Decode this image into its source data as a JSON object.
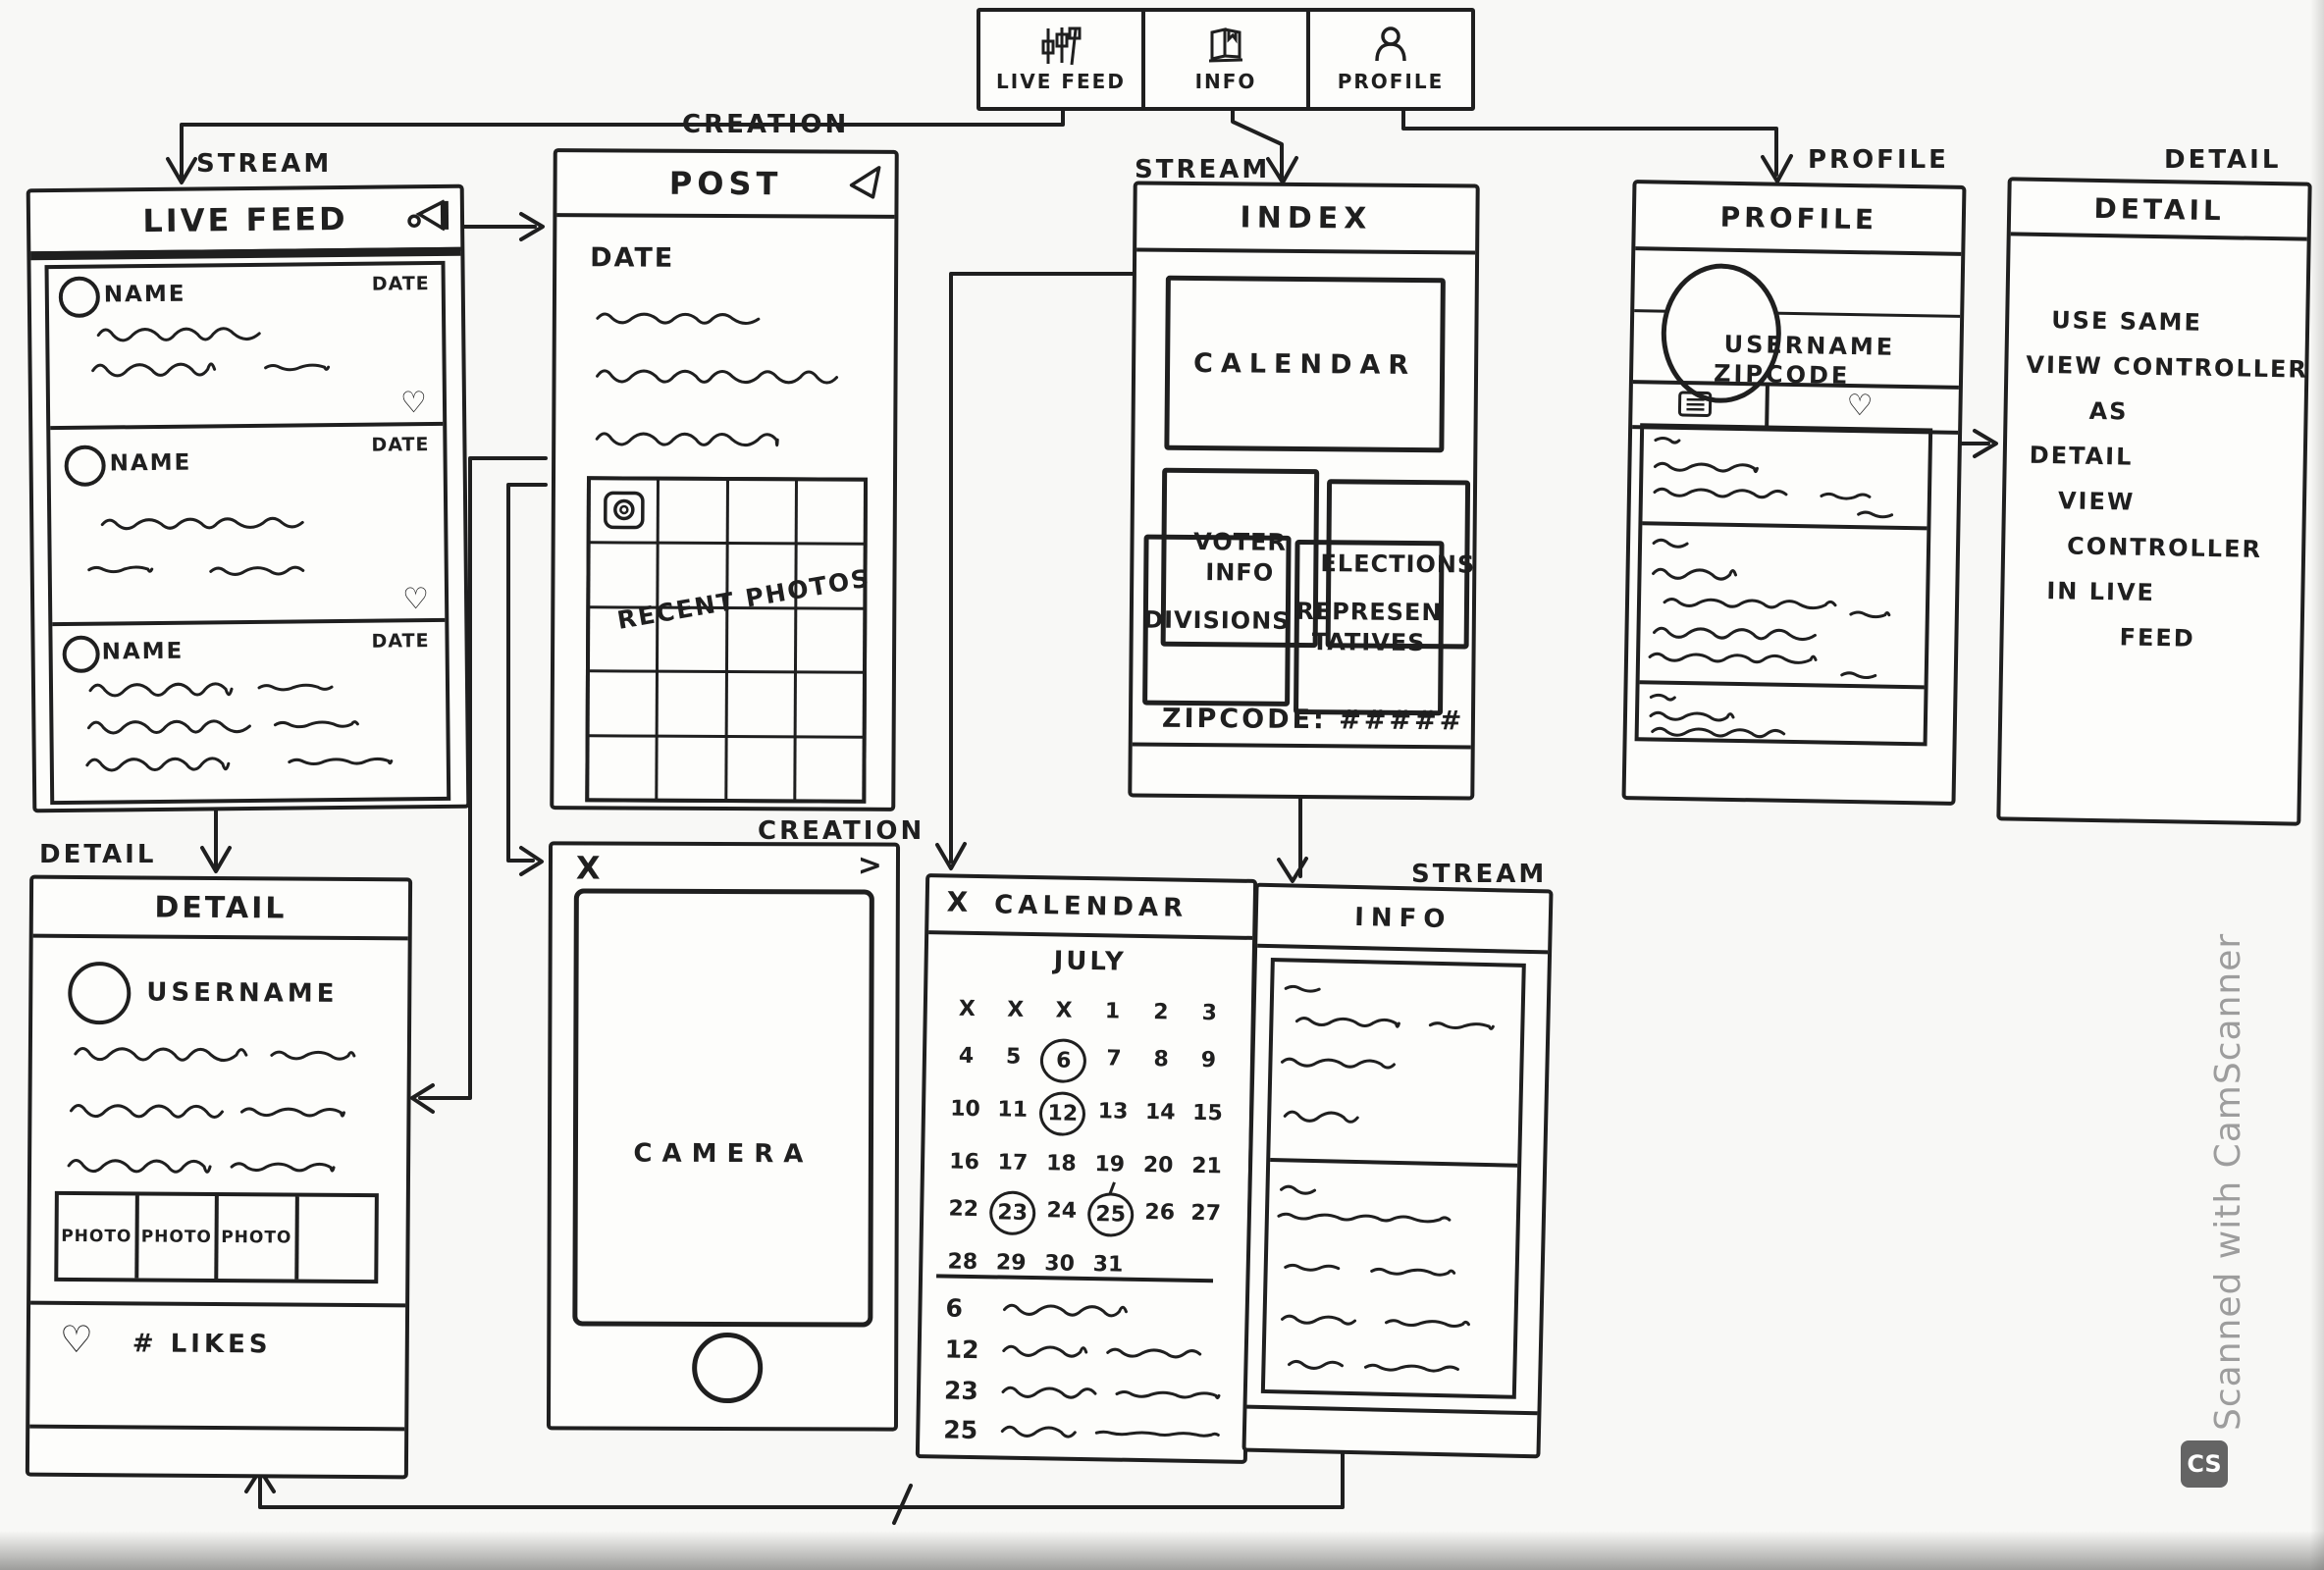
{
  "tab_bar": {
    "tabs": [
      {
        "label": "LIVE FEED",
        "icon": "sliders-icon"
      },
      {
        "label": "INFO",
        "icon": "book-icon"
      },
      {
        "label": "PROFILE",
        "icon": "person-icon"
      }
    ]
  },
  "flows": {
    "live_feed": {
      "flow_label": "STREAM",
      "title": "LIVE FEED",
      "cards": [
        {
          "name": "NAME",
          "date": "DATE"
        },
        {
          "name": "NAME",
          "date": "DATE"
        },
        {
          "name": "NAME",
          "date": "DATE"
        }
      ]
    },
    "detail_feed": {
      "flow_label": "DETAIL",
      "title": "DETAIL",
      "username": "USERNAME",
      "photos": [
        "PHOTO",
        "PHOTO",
        "PHOTO"
      ],
      "likes_label": "# LIKES"
    },
    "post": {
      "flow_label": "CREATION",
      "title": "POST",
      "date_label": "DATE",
      "grid_caption": "RECENT PHOTOS"
    },
    "camera": {
      "flow_label": "CREATION",
      "close_label": "X",
      "next_label": ">",
      "viewfinder_label": "CAMERA"
    },
    "index": {
      "flow_label": "STREAM",
      "title": "INDEX",
      "calendar_button": "CALENDAR",
      "grid_buttons": [
        [
          "VOTER",
          "INFO"
        ],
        [
          "ELECTIONS"
        ],
        [
          "DIVISIONS"
        ],
        [
          "REPRESEN",
          "TATIVES"
        ]
      ],
      "zipcode_label": "ZIPCODE: #####"
    },
    "calendar": {
      "close_label": "X",
      "title": "CALENDAR",
      "month": "JULY",
      "grid_rows": [
        [
          "X",
          "X",
          "X",
          "1",
          "2",
          "3"
        ],
        [
          "4",
          "5",
          "6",
          "7",
          "8",
          "9"
        ],
        [
          "10",
          "11",
          "12",
          "13",
          "14",
          "15"
        ],
        [
          "16",
          "17",
          "18",
          "19",
          "20",
          "21"
        ],
        [
          "22",
          "23",
          "24",
          "25",
          "26",
          "27"
        ],
        [
          "28",
          "29",
          "30",
          "31",
          "",
          ""
        ]
      ],
      "circled_days": [
        "6",
        "12",
        "23",
        "25"
      ],
      "event_days": [
        "6",
        "12",
        "23",
        "25"
      ]
    },
    "info": {
      "flow_label": "STREAM",
      "title": "INFO"
    },
    "profile": {
      "flow_label": "PROFILE",
      "title": "PROFILE",
      "username": "USERNAME",
      "zipcode": "ZIPCODE"
    },
    "detail_reuse": {
      "flow_label": "DETAIL",
      "title": "DETAIL",
      "note_lines": [
        "USE SAME",
        "VIEW CONTROLLER",
        "AS",
        "DETAIL",
        "VIEW",
        "CONTROLLER",
        "IN LIVE",
        "FEED"
      ]
    }
  },
  "watermark": {
    "text": "Scanned with CamScanner",
    "logo_label": "CS"
  }
}
